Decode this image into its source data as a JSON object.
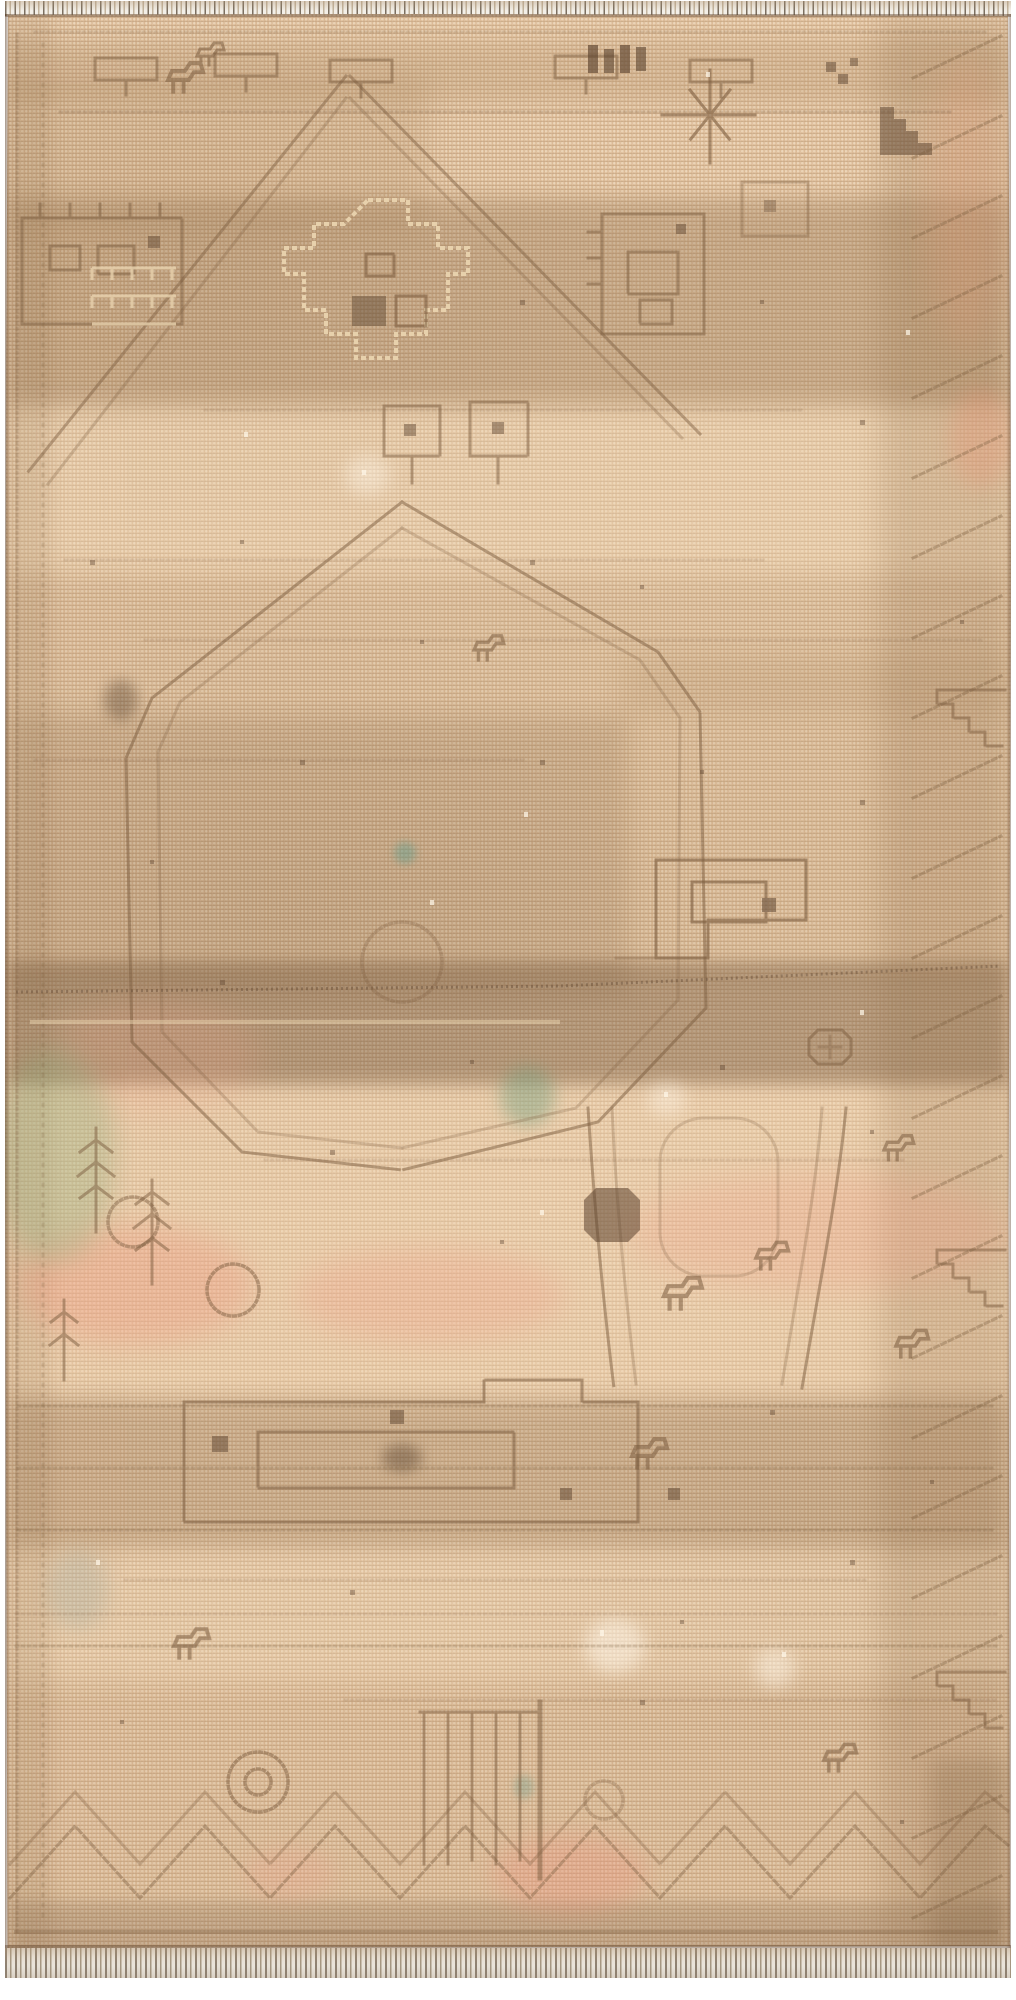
{
  "image": {
    "type": "photograph",
    "subject": "Antique hand-knotted tribal rug, heavily faded and distressed",
    "alt": "Full-length photo of a vintage beige-tan Persian tribal rug with faded geometric medallions, stepped motifs, dark brown abrash bands, pale pink and sage dye traces, and short fringe at the top and bottom edges",
    "orientation": "portrait"
  },
  "palette": {
    "backdrop": "#ffffff",
    "base": "#dcbb97",
    "base_light": "#ecd3b2",
    "base_dark": "#c5a37e",
    "band_brown": "#9b7b58",
    "motif_brown": "#7d5e40",
    "motif_dark": "#5c4430",
    "motif_light": "#e9d3ae",
    "blush_pink": "#ef9f88",
    "sage_green": "#8fae7e",
    "teal_spot": "#6f9e8e",
    "fringe_light": "#f3efe7",
    "fringe_dark": "#7b6f60",
    "selvedge": "#6e543c"
  },
  "washes": [
    {
      "name": "top-border-shadow",
      "x": 3,
      "y": 28,
      "w": 1000,
      "h": 60,
      "color": "#a8865f",
      "opacity": 0.22,
      "blur": 8,
      "shape": "rect"
    },
    {
      "name": "upper-left-warm",
      "x": 3,
      "y": 60,
      "w": 420,
      "h": 160,
      "color": "#a8865f",
      "opacity": 0.18,
      "blur": 12,
      "shape": "rect"
    },
    {
      "name": "upper-dark-band",
      "x": 3,
      "y": 185,
      "w": 1000,
      "h": 210,
      "color": "#8a6a48",
      "opacity": 0.3,
      "blur": 10,
      "shape": "rect"
    },
    {
      "name": "light-zone-upper",
      "x": 3,
      "y": 390,
      "w": 1000,
      "h": 170,
      "color": "#f0d9b8",
      "opacity": 0.3,
      "blur": 12,
      "shape": "rect"
    },
    {
      "name": "mid-shadow",
      "x": 3,
      "y": 560,
      "w": 1000,
      "h": 140,
      "color": "#a88762",
      "opacity": 0.14,
      "blur": 12,
      "shape": "rect"
    },
    {
      "name": "center-left-dark",
      "x": 3,
      "y": 700,
      "w": 620,
      "h": 280,
      "color": "#8a6a48",
      "opacity": 0.26,
      "blur": 12,
      "shape": "rect"
    },
    {
      "name": "center-right-mid",
      "x": 615,
      "y": 640,
      "w": 390,
      "h": 330,
      "color": "#a8865f",
      "opacity": 0.16,
      "blur": 14,
      "shape": "rect"
    },
    {
      "name": "central-dark-band",
      "x": 3,
      "y": 948,
      "w": 1000,
      "h": 124,
      "color": "#74573c",
      "opacity": 0.4,
      "blur": 7,
      "shape": "rect"
    },
    {
      "name": "peach-zone",
      "x": 3,
      "y": 1072,
      "w": 1000,
      "h": 310,
      "color": "#f3d7b4",
      "opacity": 0.34,
      "blur": 12,
      "shape": "rect"
    },
    {
      "name": "lower-brown-band",
      "x": 3,
      "y": 1385,
      "w": 1000,
      "h": 150,
      "color": "#8a6a48",
      "opacity": 0.26,
      "blur": 10,
      "shape": "rect"
    },
    {
      "name": "light-zone-lower",
      "x": 3,
      "y": 1538,
      "w": 1000,
      "h": 130,
      "color": "#eed6b5",
      "opacity": 0.26,
      "blur": 12,
      "shape": "rect"
    },
    {
      "name": "lower-mid-warm",
      "x": 3,
      "y": 1668,
      "w": 1000,
      "h": 220,
      "color": "#b08a62",
      "opacity": 0.14,
      "blur": 12,
      "shape": "rect"
    },
    {
      "name": "bottom-dark-band",
      "x": 3,
      "y": 1888,
      "w": 1000,
      "h": 60,
      "color": "#7c5f42",
      "opacity": 0.3,
      "blur": 8,
      "shape": "rect"
    },
    {
      "name": "right-border-strip",
      "x": 875,
      "y": 0,
      "w": 130,
      "h": 1934,
      "color": "#8a6a48",
      "opacity": 0.2,
      "blur": 14,
      "shape": "rect"
    },
    {
      "name": "left-border-strip",
      "x": 0,
      "y": 0,
      "w": 46,
      "h": 1934,
      "color": "#8a6a48",
      "opacity": 0.14,
      "blur": 8,
      "shape": "rect"
    },
    {
      "name": "right-bottom-block",
      "x": 925,
      "y": 1745,
      "w": 80,
      "h": 195,
      "color": "#7c5f42",
      "opacity": 0.25,
      "blur": 10,
      "shape": "rect"
    },
    {
      "name": "pink-patch-left",
      "x": 13,
      "y": 1211,
      "w": 235,
      "h": 120,
      "color": "#ef8f78",
      "opacity": 0.3,
      "blur": 14,
      "shape": "round"
    },
    {
      "name": "pink-patch-center",
      "x": 290,
      "y": 1234,
      "w": 270,
      "h": 95,
      "color": "#f09a84",
      "opacity": 0.26,
      "blur": 14,
      "shape": "round"
    },
    {
      "name": "pink-patch-right",
      "x": 623,
      "y": 1158,
      "w": 380,
      "h": 120,
      "color": "#ef9f88",
      "opacity": 0.26,
      "blur": 16,
      "shape": "round"
    },
    {
      "name": "pink-patch-left-high",
      "x": 50,
      "y": 986,
      "w": 205,
      "h": 115,
      "color": "#ef9f88",
      "opacity": 0.18,
      "blur": 16,
      "shape": "round"
    },
    {
      "name": "pink-right-edge-top",
      "x": 925,
      "y": 46,
      "w": 75,
      "h": 290,
      "color": "#e89a78",
      "opacity": 0.2,
      "blur": 16,
      "shape": "round"
    },
    {
      "name": "pink-right-notch",
      "x": 945,
      "y": 374,
      "w": 62,
      "h": 100,
      "color": "#ea8f70",
      "opacity": 0.28,
      "blur": 10,
      "shape": "round"
    },
    {
      "name": "pink-bottom-center",
      "x": 487,
      "y": 1821,
      "w": 155,
      "h": 78,
      "color": "#ee8f7c",
      "opacity": 0.3,
      "blur": 12,
      "shape": "round"
    },
    {
      "name": "pink-bottom-left",
      "x": 240,
      "y": 1834,
      "w": 90,
      "h": 52,
      "color": "#ee9f8c",
      "opacity": 0.24,
      "blur": 10,
      "shape": "round"
    },
    {
      "name": "sage-patch-left",
      "x": -10,
      "y": 1034,
      "w": 120,
      "h": 215,
      "color": "#8fae7e",
      "opacity": 0.32,
      "blur": 12,
      "shape": "round"
    },
    {
      "name": "teal-spot-center",
      "x": 495,
      "y": 1052,
      "w": 55,
      "h": 60,
      "color": "#6f9e7e",
      "opacity": 0.4,
      "blur": 8,
      "shape": "round"
    },
    {
      "name": "gray-spot-left-low",
      "x": 43,
      "y": 1536,
      "w": 60,
      "h": 80,
      "color": "#9aa8a0",
      "opacity": 0.28,
      "blur": 10,
      "shape": "round"
    },
    {
      "name": "teal-dot-upper",
      "x": 389,
      "y": 828,
      "w": 22,
      "h": 22,
      "color": "#5f9e8e",
      "opacity": 0.45,
      "blur": 4,
      "shape": "round"
    },
    {
      "name": "teal-dot-lower",
      "x": 509,
      "y": 1761,
      "w": 20,
      "h": 24,
      "color": "#6f9e8e",
      "opacity": 0.35,
      "blur": 4,
      "shape": "round"
    },
    {
      "name": "white-wear-1",
      "x": 580,
      "y": 1604,
      "w": 60,
      "h": 55,
      "color": "#fff6e8",
      "opacity": 0.5,
      "blur": 8,
      "shape": "round"
    },
    {
      "name": "white-wear-2",
      "x": 750,
      "y": 1634,
      "w": 40,
      "h": 40,
      "color": "#fff6e8",
      "opacity": 0.45,
      "blur": 8,
      "shape": "round"
    },
    {
      "name": "white-wear-3",
      "x": 340,
      "y": 441,
      "w": 45,
      "h": 40,
      "color": "#fff6e8",
      "opacity": 0.4,
      "blur": 8,
      "shape": "round"
    },
    {
      "name": "white-wear-4",
      "x": 643,
      "y": 1068,
      "w": 38,
      "h": 34,
      "color": "#fff6e8",
      "opacity": 0.4,
      "blur": 8,
      "shape": "round"
    },
    {
      "name": "dark-smudge-1",
      "x": 377,
      "y": 1430,
      "w": 40,
      "h": 28,
      "color": "#4f3a28",
      "opacity": 0.4,
      "blur": 6,
      "shape": "round"
    },
    {
      "name": "dark-smudge-2",
      "x": 99,
      "y": 666,
      "w": 34,
      "h": 40,
      "color": "#4f3a28",
      "opacity": 0.35,
      "blur": 6,
      "shape": "round"
    }
  ],
  "fringe": {
    "top_height": 15,
    "bottom_height": 30
  }
}
